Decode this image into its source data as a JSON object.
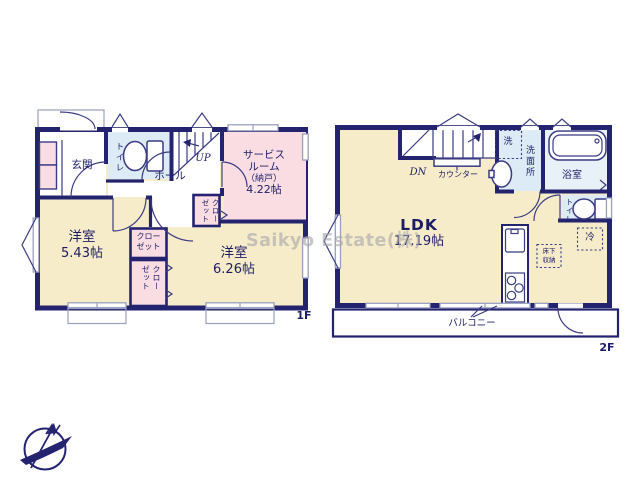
{
  "watermark": "Saikyo Estate(株)",
  "colors": {
    "wall": "#232370",
    "line": "#3b3b85",
    "text": "#1d1d66",
    "cream": "#f6ecc9",
    "pink": "#f9dde2",
    "blue": "#dcebf5",
    "watermark": "rgba(166,166,173,0.62)"
  },
  "floor1": {
    "floor_label": "1F",
    "entrance": "玄関",
    "toilet": "トイレ",
    "hall": "ホール",
    "stairs": "UP",
    "service_room": {
      "name_line1": "サービス",
      "name_line2": "ルーム",
      "name_line3": "（納戸）",
      "size": "4.22帖"
    },
    "room1": {
      "name": "洋室",
      "size": "5.43帖"
    },
    "room2": {
      "name": "洋室",
      "size": "6.26帖"
    },
    "closet_hall": "クローゼット",
    "closet_top": "クローゼット",
    "closet_bottom": "クローゼット"
  },
  "floor2": {
    "floor_label": "2F",
    "ldk": {
      "name": "LDK",
      "size": "17.19帖"
    },
    "stairs": "DN",
    "counter": "カウンター",
    "washer": "洗",
    "washroom": "洗面所",
    "bathroom": "浴室",
    "toilet": "トイレ",
    "refrigerator": "冷",
    "underfloor_storage": "床下収納",
    "balcony": "バルコニー"
  }
}
